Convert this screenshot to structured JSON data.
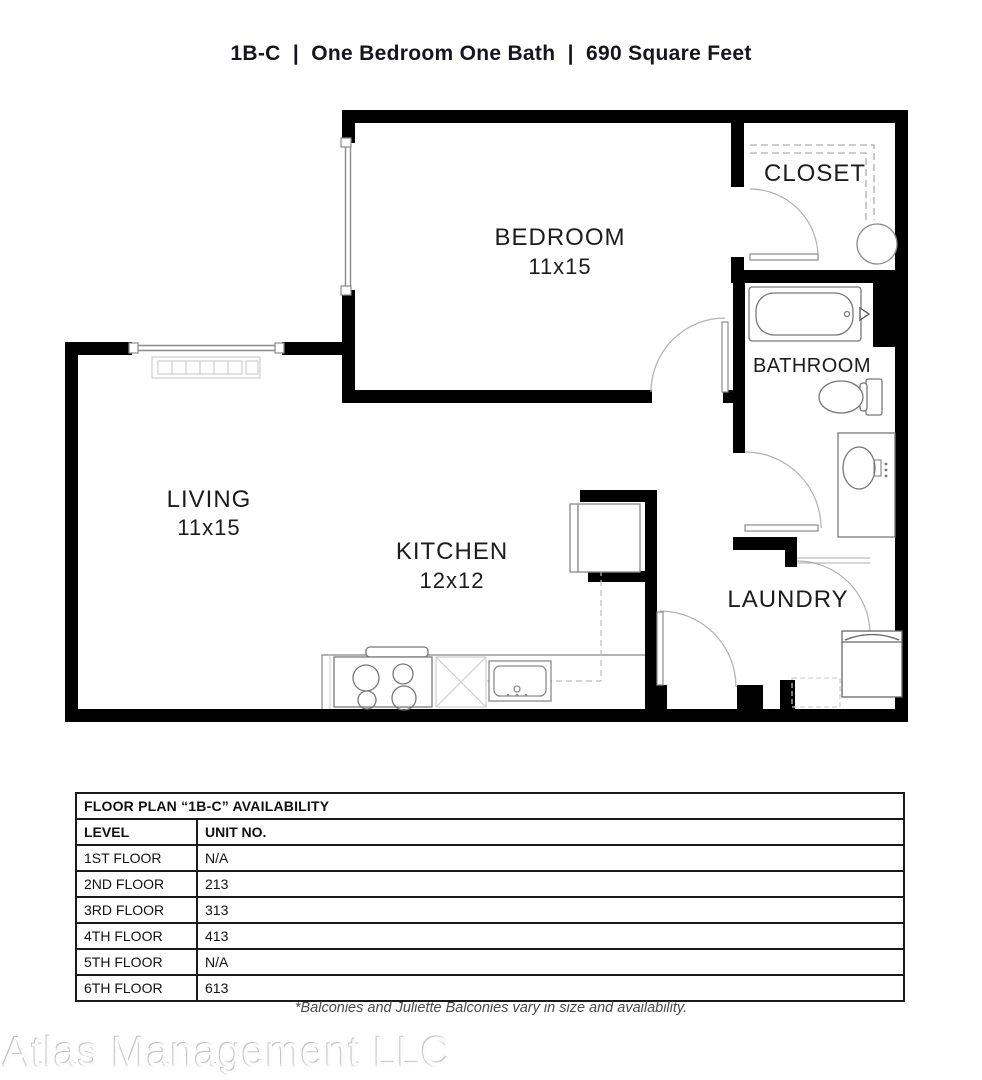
{
  "title": "1B-C  |  One Bedroom One Bath  |  690 Square Feet",
  "floor_plan": {
    "rooms": [
      {
        "name": "BEDROOM",
        "dims": "11x15"
      },
      {
        "name": "CLOSET",
        "dims": ""
      },
      {
        "name": "BATHROOM",
        "dims": ""
      },
      {
        "name": "LIVING",
        "dims": "11x15"
      },
      {
        "name": "KITCHEN",
        "dims": "12x12"
      },
      {
        "name": "LAUNDRY",
        "dims": ""
      }
    ]
  },
  "availability_table": {
    "title": "FLOOR PLAN “1B-C” AVAILABILITY",
    "columns": [
      "LEVEL",
      "UNIT NO."
    ],
    "rows": [
      {
        "level": "1ST FLOOR",
        "unit": "N/A"
      },
      {
        "level": "2ND FLOOR",
        "unit": "213"
      },
      {
        "level": "3RD FLOOR",
        "unit": "313"
      },
      {
        "level": "4TH FLOOR",
        "unit": "413"
      },
      {
        "level": "5TH FLOOR",
        "unit": "N/A"
      },
      {
        "level": "6TH FLOOR",
        "unit": "613"
      }
    ]
  },
  "footnote": "*Balconies and Juliette Balconies vary in size and availability.",
  "watermark": "Atlas Management LLC",
  "colors": {
    "wall": "#000000",
    "fixture_stroke": "#787878",
    "door_arc": "#b0b0b0",
    "light_detail": "#cfcfcf",
    "text": "#1c1c1c"
  }
}
